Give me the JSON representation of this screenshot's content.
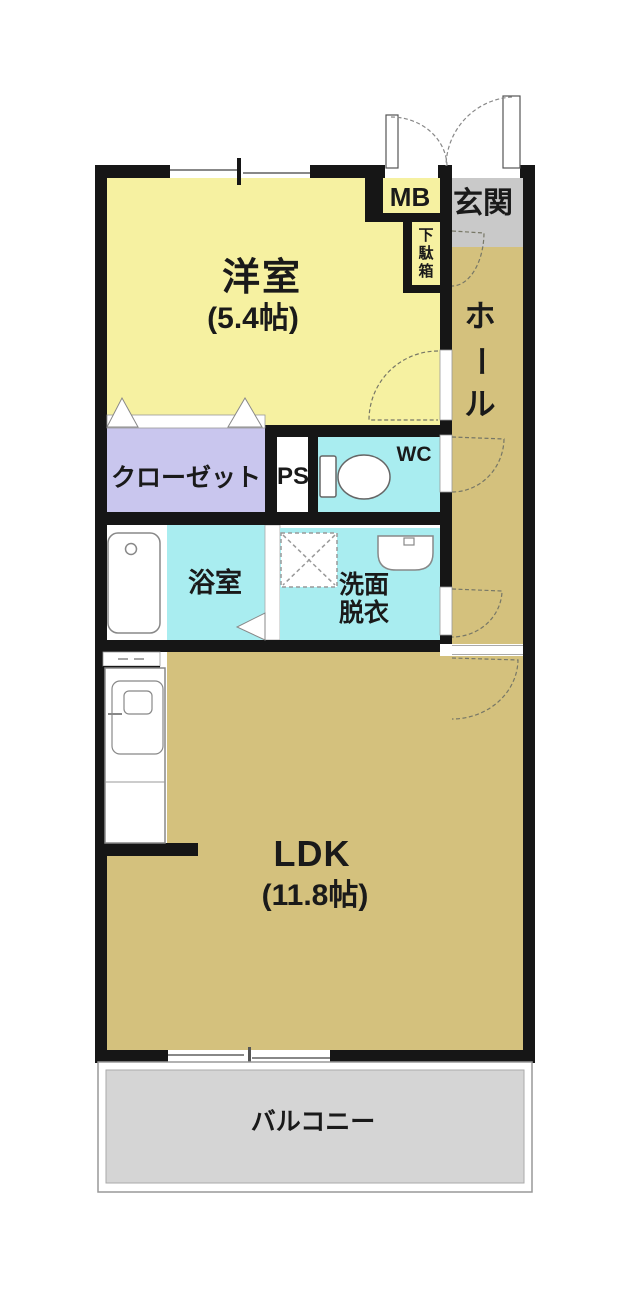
{
  "colors": {
    "wall": "#161616",
    "western_room_fill": "#f6f1a1",
    "tan_fill": "#d4c17d",
    "wet_fill": "#a9edf0",
    "closet_fill": "#c9c6ee",
    "entrance_fill": "#c9c9c9",
    "balcony_fill": "#d5d5d5"
  },
  "rooms": {
    "western_room": {
      "label": "洋室",
      "size": "(5.4帖)"
    },
    "ldk": {
      "label": "LDK",
      "size": "(11.8帖)"
    },
    "closet": {
      "label": "クローゼット"
    },
    "pipe_space": {
      "label": "PS"
    },
    "toilet": {
      "label": "WC"
    },
    "bathroom": {
      "label": "浴室"
    },
    "washroom": {
      "line1": "洗面",
      "line2": "脱衣"
    },
    "entrance": {
      "label": "玄関"
    },
    "hall": {
      "chars": [
        "ホ",
        "ー",
        "ル"
      ]
    },
    "shoe_cabinet": {
      "chars": [
        "下",
        "駄",
        "箱"
      ]
    },
    "meter_box": {
      "label": "MB"
    },
    "balcony": {
      "label": "バルコニー"
    }
  }
}
